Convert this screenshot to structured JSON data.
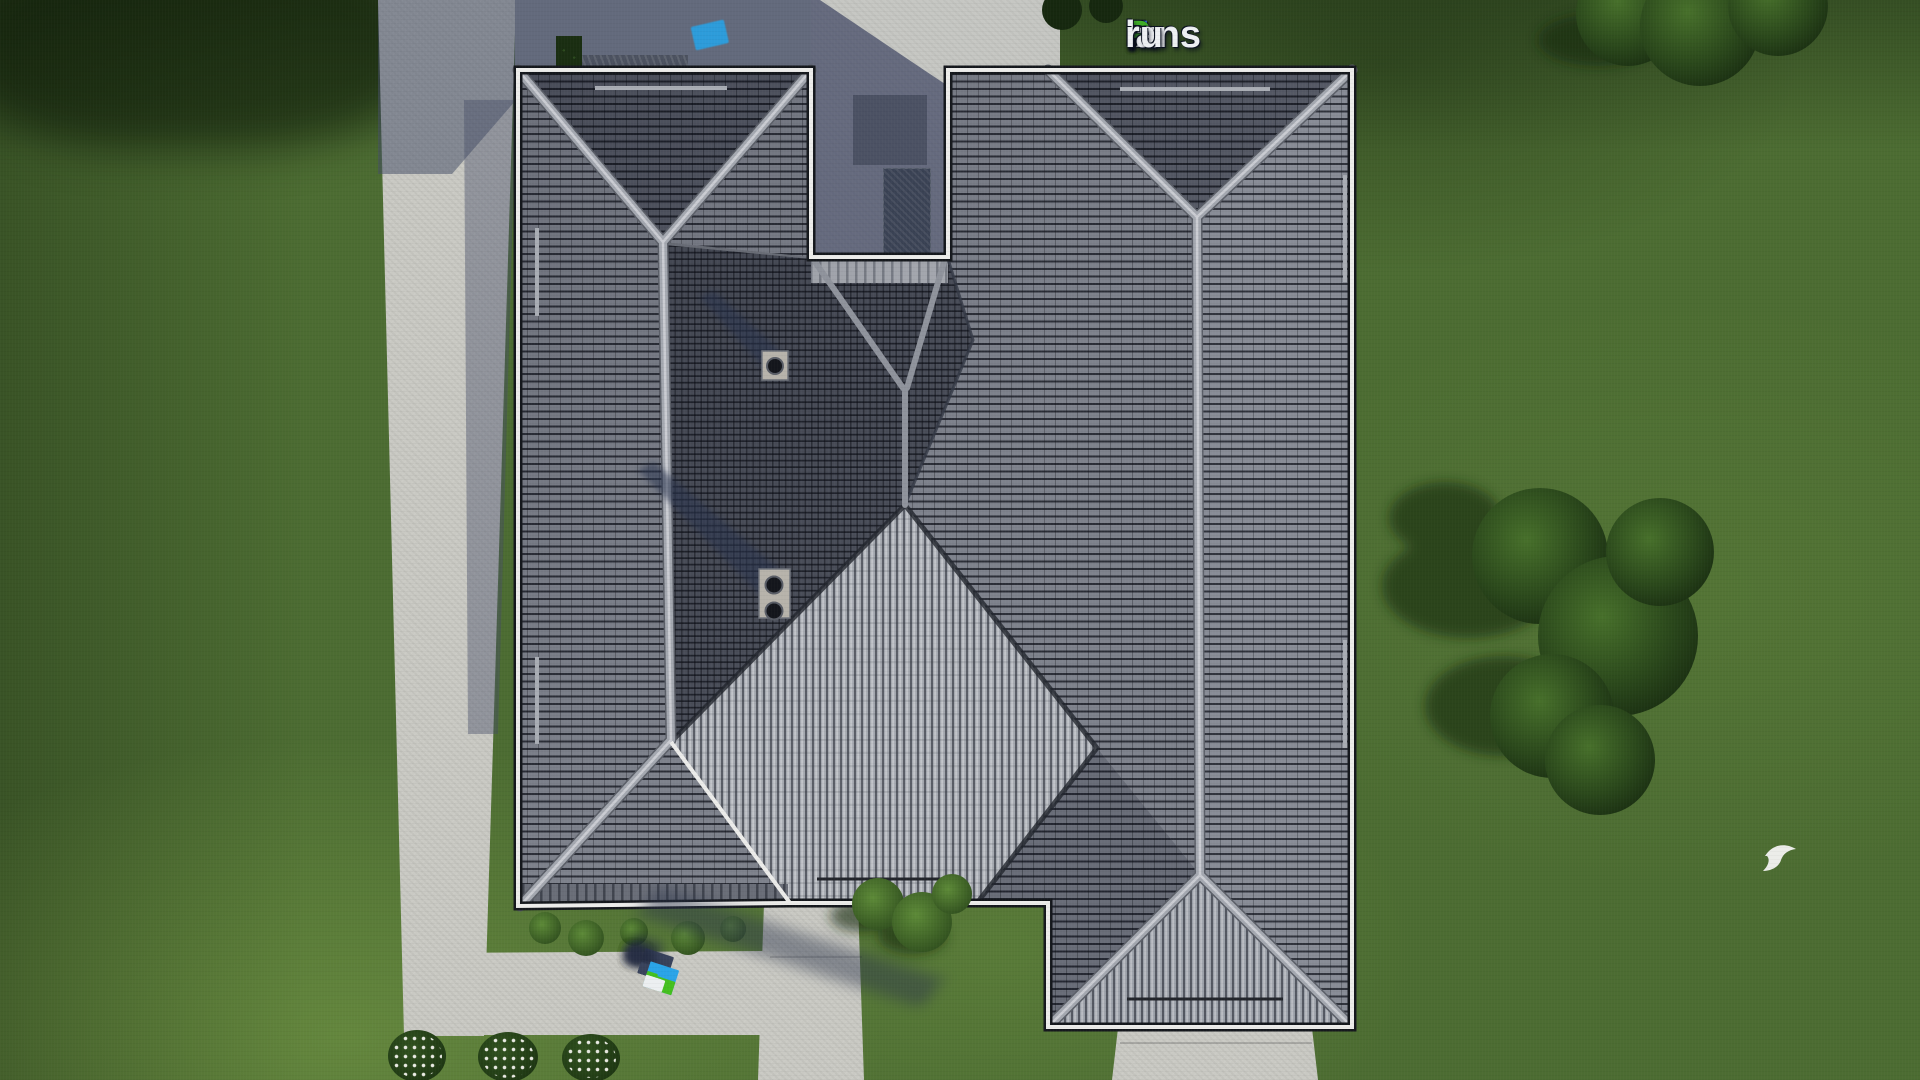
{
  "scene": {
    "type": "3d-aerial-render",
    "subject": "Top-down aerial view of a single-family house hip roof with gray tiles, surrounded by lawn, concrete paths, trees and bushes",
    "view": "top-down"
  },
  "branding": {
    "site": "FixPlans.ru",
    "logo_segments": [
      {
        "text": "F",
        "color": "#2e6fe0"
      },
      {
        "text": "ix",
        "color": "#eef0f3"
      },
      {
        "text": "P",
        "color": "#3fae27"
      },
      {
        "text": "lans",
        "color": "#eef0f3"
      },
      {
        "text": ".",
        "color": "#2e6fe0"
      },
      {
        "text": "ru",
        "color": "#eef0f3"
      }
    ]
  },
  "palette": {
    "grass": "#4c6c32",
    "grass_light": "#6f9440",
    "grass_shadow": "#22391a",
    "path_concrete": "#c9c9c3",
    "roof_tile_medium": "#7e828c",
    "roof_tile_dark": "#555965",
    "roof_tile_light_ribs": "#a4a8af",
    "roof_cross_dark": "#4a4e59",
    "ridge_cap": "#a4a8b0",
    "fascia_white": "#ececea",
    "shadow_blue": "#5c6274",
    "brand_blue": "#2e6fe0",
    "brand_green": "#3fae27",
    "watermark_cyan": "#2aa4e8",
    "tree_dark_green": "#1c3414",
    "tree_mid_green": "#3f6526"
  },
  "watermarks": {
    "diagonal_blocks": {
      "rotation_deg": -13,
      "blocks": [
        {
          "w": 20,
          "h": 9,
          "color": "#e8e9ea"
        },
        {
          "w": 16,
          "h": 9,
          "color": "#e8e9ea"
        },
        {
          "w": 13,
          "h": 12,
          "color": "#2456c8"
        },
        {
          "w": 22,
          "h": 10,
          "color": "#e8e9ea"
        },
        {
          "w": 18,
          "h": 10,
          "color": "#e8e9ea"
        },
        {
          "w": 15,
          "h": 10,
          "color": "#e8e9ea"
        },
        {
          "w": 15,
          "h": 15,
          "color": "#47b42a"
        },
        {
          "w": 13,
          "h": 14,
          "color": "#e8e9ea"
        },
        {
          "w": 14,
          "h": 15,
          "color": "#47b42a"
        },
        {
          "w": 12,
          "h": 14,
          "color": "#e8e9ea"
        },
        {
          "w": 34,
          "h": 24,
          "color": "#2b9fe0"
        }
      ]
    },
    "extruded_blocks": {
      "rotation_deg": 18,
      "blocks": [
        {
          "w": 30,
          "h": 26,
          "color": "#2aa4e8"
        },
        {
          "w": 11,
          "h": 16,
          "color": "#44c020"
        },
        {
          "w": 16,
          "h": 12,
          "color": "#eceff1"
        },
        {
          "w": 14,
          "h": 12,
          "color": "#eceff1"
        },
        {
          "w": 30,
          "h": 14,
          "color": "#44c020"
        },
        {
          "w": 18,
          "h": 12,
          "color": "#eceff1"
        },
        {
          "w": 16,
          "h": 12,
          "color": "#eceff1"
        },
        {
          "w": 20,
          "h": 12,
          "color": "#eceff1"
        },
        {
          "w": 10,
          "h": 10,
          "color": "#2aa4e8"
        },
        {
          "w": 14,
          "h": 11,
          "color": "#eceff1"
        },
        {
          "w": 18,
          "h": 11,
          "color": "#eceff1"
        }
      ]
    }
  },
  "objects": [
    "hip-roof-with-two-ridge-junctions",
    "central-dark-pyramid-roof",
    "light-ribbed-prow-face",
    "roof-vent-single-pipe",
    "roof-vent-double-pipe",
    "left-sidewalk",
    "bottom-sidewalk",
    "entrance-path",
    "terrace-courtyard",
    "tree-cluster-right",
    "tree-cluster-top-right",
    "flowering-bushes-bottom-left",
    "white-bird-on-lawn"
  ]
}
